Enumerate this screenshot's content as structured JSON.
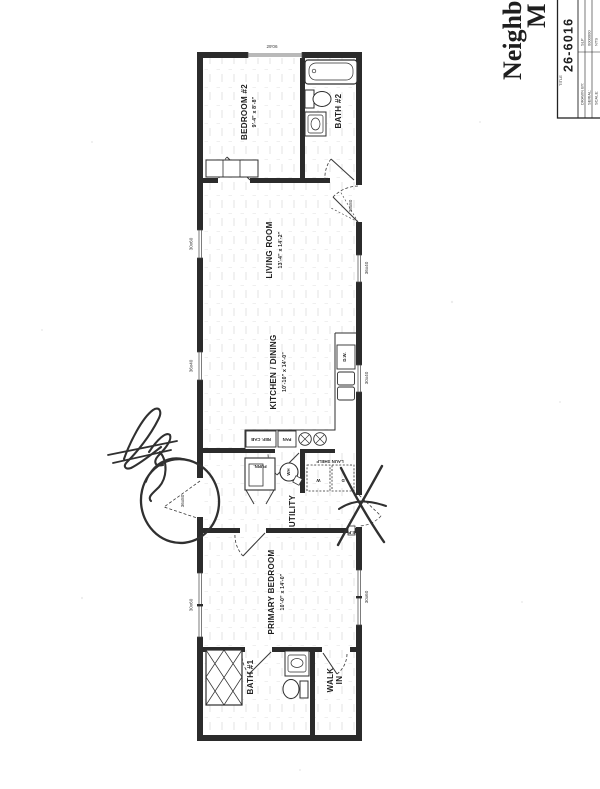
{
  "title_block": {
    "model_name_line1": "Neighborhood",
    "model_name_line2": "M",
    "area_text": "900 Square",
    "title_label": "TITLE",
    "plan_number": "26-6016",
    "fields": [
      {
        "label": "DRAWN BY:",
        "value": "SLP"
      },
      {
        "label": "SERIAL:",
        "value": "0000000"
      },
      {
        "label": "SCALE:",
        "value": "NTS"
      }
    ]
  },
  "rooms": {
    "bedroom2": {
      "name": "BEDROOM #2",
      "dims": "9'-4\" x 8'-8\""
    },
    "bath2": {
      "name": "BATH #2"
    },
    "living": {
      "name": "LIVING ROOM",
      "dims": "13'-4\" x 14'-2\""
    },
    "kitchen": {
      "name": "KITCHEN / DINING",
      "dims": "10'-10\" x 14'-0\""
    },
    "utility": {
      "name": "UTILITY"
    },
    "primary": {
      "name": "PRIMARY BEDROOM",
      "dims": "10'-0\" x 14'-0\""
    },
    "bath1": {
      "name": "BATH #1"
    },
    "walkin_line1": "WALK",
    "walkin_line2": "IN"
  },
  "fixtures": {
    "furnace": "FURN.",
    "water_heater": "WH",
    "laundry_shelf": "LAUN SHELF",
    "washer": "W",
    "dryer": "D",
    "dishwasher": "D.W.",
    "ref_cabinet": "REF. CAB",
    "pantry": "PAN",
    "electrical_panel": "E.P."
  },
  "openings": {
    "top_window": "29'06",
    "left_window_living": "30x60",
    "left_window_kitchen": "36x40",
    "left_window_primary": "30x60",
    "right_entry_door": "36x80",
    "right_window_living": "36x40",
    "right_window_kitchen": "30x40",
    "right_window_primary": "30x60",
    "circled_door": "36x80"
  }
}
